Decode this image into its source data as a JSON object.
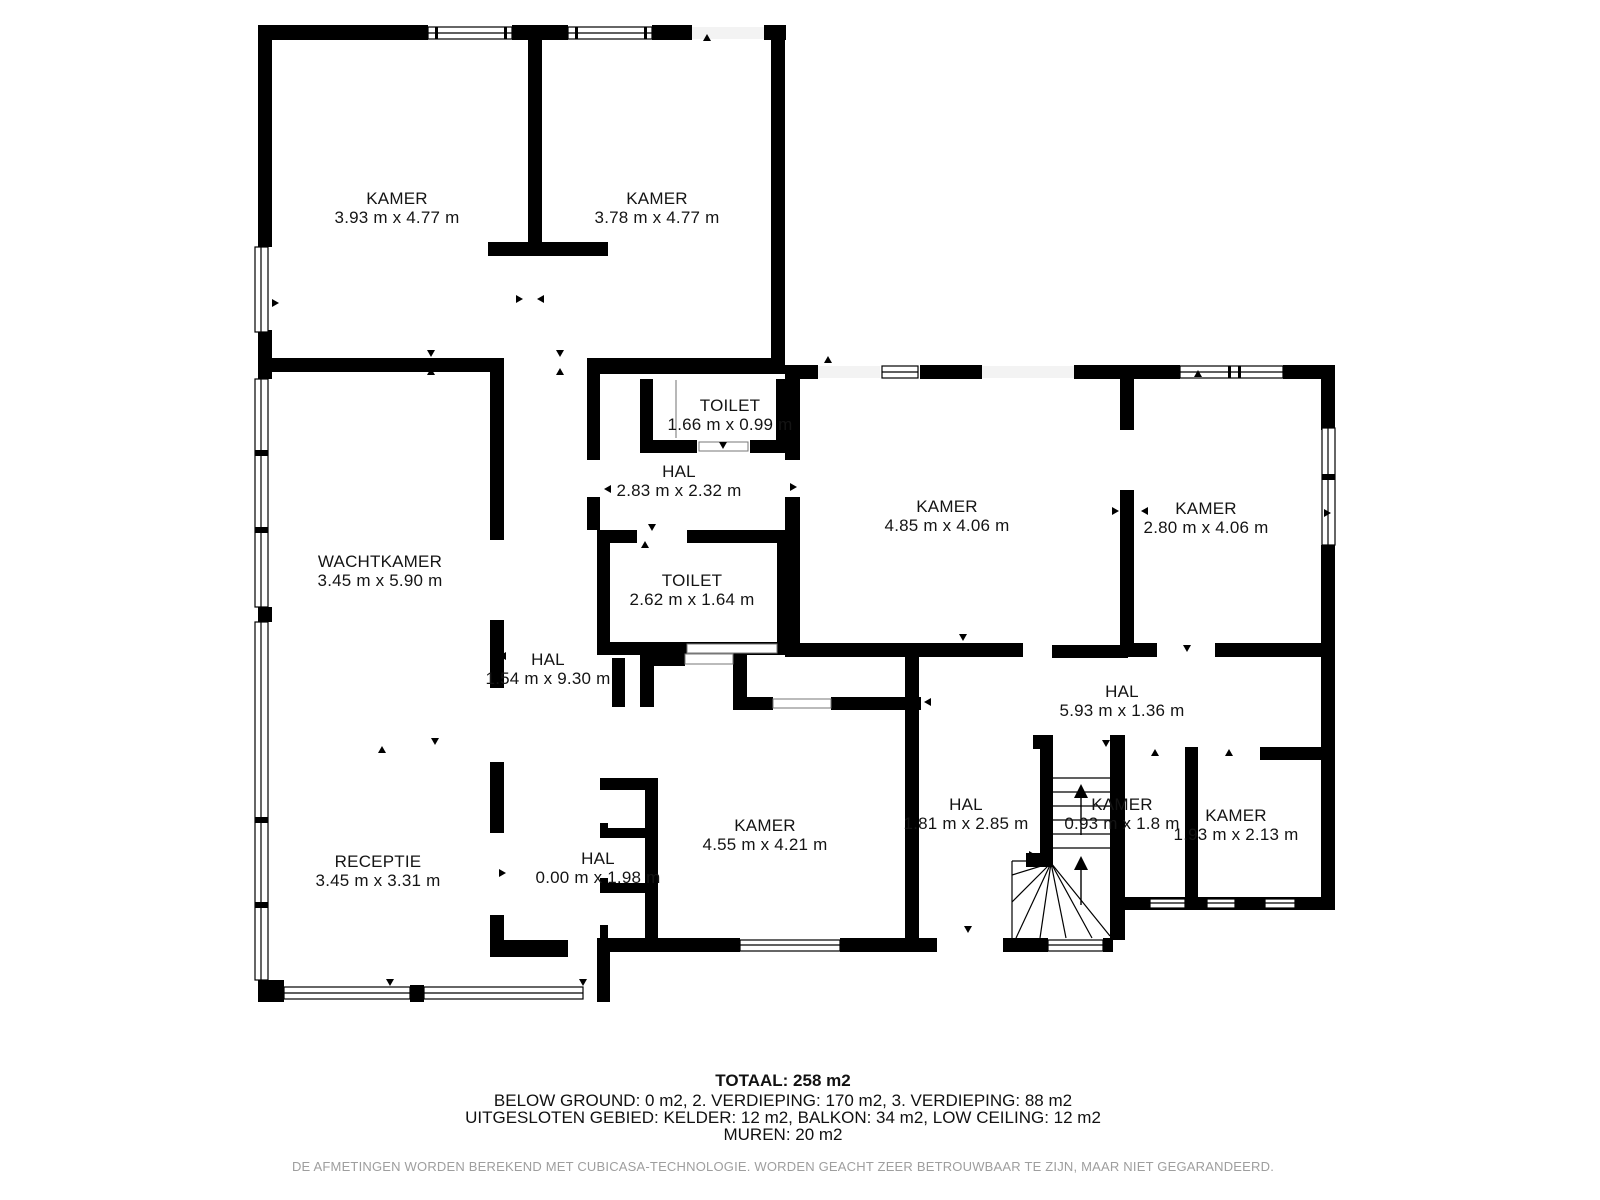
{
  "plan": {
    "rooms": [
      {
        "name": "KAMER",
        "dims": "3.93 m x 4.77 m",
        "x": 397,
        "y": 208
      },
      {
        "name": "KAMER",
        "dims": "3.78 m x 4.77 m",
        "x": 657,
        "y": 208
      },
      {
        "name": "TOILET",
        "dims": "1.66 m x 0.99 m",
        "x": 730,
        "y": 415
      },
      {
        "name": "HAL",
        "dims": "2.83 m x 2.32 m",
        "x": 679,
        "y": 481
      },
      {
        "name": "KAMER",
        "dims": "4.85 m x 4.06 m",
        "x": 947,
        "y": 516
      },
      {
        "name": "KAMER",
        "dims": "2.80 m x 4.06 m",
        "x": 1206,
        "y": 518
      },
      {
        "name": "WACHTKAMER",
        "dims": "3.45 m x 5.90 m",
        "x": 380,
        "y": 571
      },
      {
        "name": "TOILET",
        "dims": "2.62 m x 1.64 m",
        "x": 692,
        "y": 590
      },
      {
        "name": "HAL",
        "dims": "1.54 m x 9.30 m",
        "x": 548,
        "y": 669
      },
      {
        "name": "HAL",
        "dims": "5.93 m x 1.36 m",
        "x": 1122,
        "y": 701
      },
      {
        "name": "KAMER",
        "dims": "4.55 m x 4.21 m",
        "x": 765,
        "y": 835
      },
      {
        "name": "HAL",
        "dims": "1.81 m x 2.85 m",
        "x": 966,
        "y": 814
      },
      {
        "name": "KAMER",
        "dims": "0.93 m x 1.8 m",
        "x": 1122,
        "y": 814
      },
      {
        "name": "KAMER",
        "dims": "1.93 m x 2.13 m",
        "x": 1236,
        "y": 825
      },
      {
        "name": "RECEPTIE",
        "dims": "3.45 m x 3.31 m",
        "x": 378,
        "y": 871
      },
      {
        "name": "HAL",
        "dims": "0.00 m x 1.98 m",
        "x": 598,
        "y": 868
      }
    ],
    "footer": {
      "total": "TOTAAL: 258 m2",
      "line2": "BELOW GROUND: 0 m2, 2. VERDIEPING: 170 m2, 3. VERDIEPING: 88 m2",
      "line3": "UITGESLOTEN GEBIED: KELDER: 12 m2, BALKON: 34 m2, LOW CEILING: 12 m2",
      "line4": "MUREN: 20 m2",
      "disclaimer": "DE AFMETINGEN WORDEN BEREKEND MET CUBICASA-TECHNOLOGIE. WORDEN GEACHT ZEER BETROUWBAAR TE ZIJN, MAAR NIET GEGARANDEERD."
    },
    "colors": {
      "wall": "#000000",
      "background": "#ffffff",
      "disclaimer_text": "#9e9e9e"
    }
  }
}
